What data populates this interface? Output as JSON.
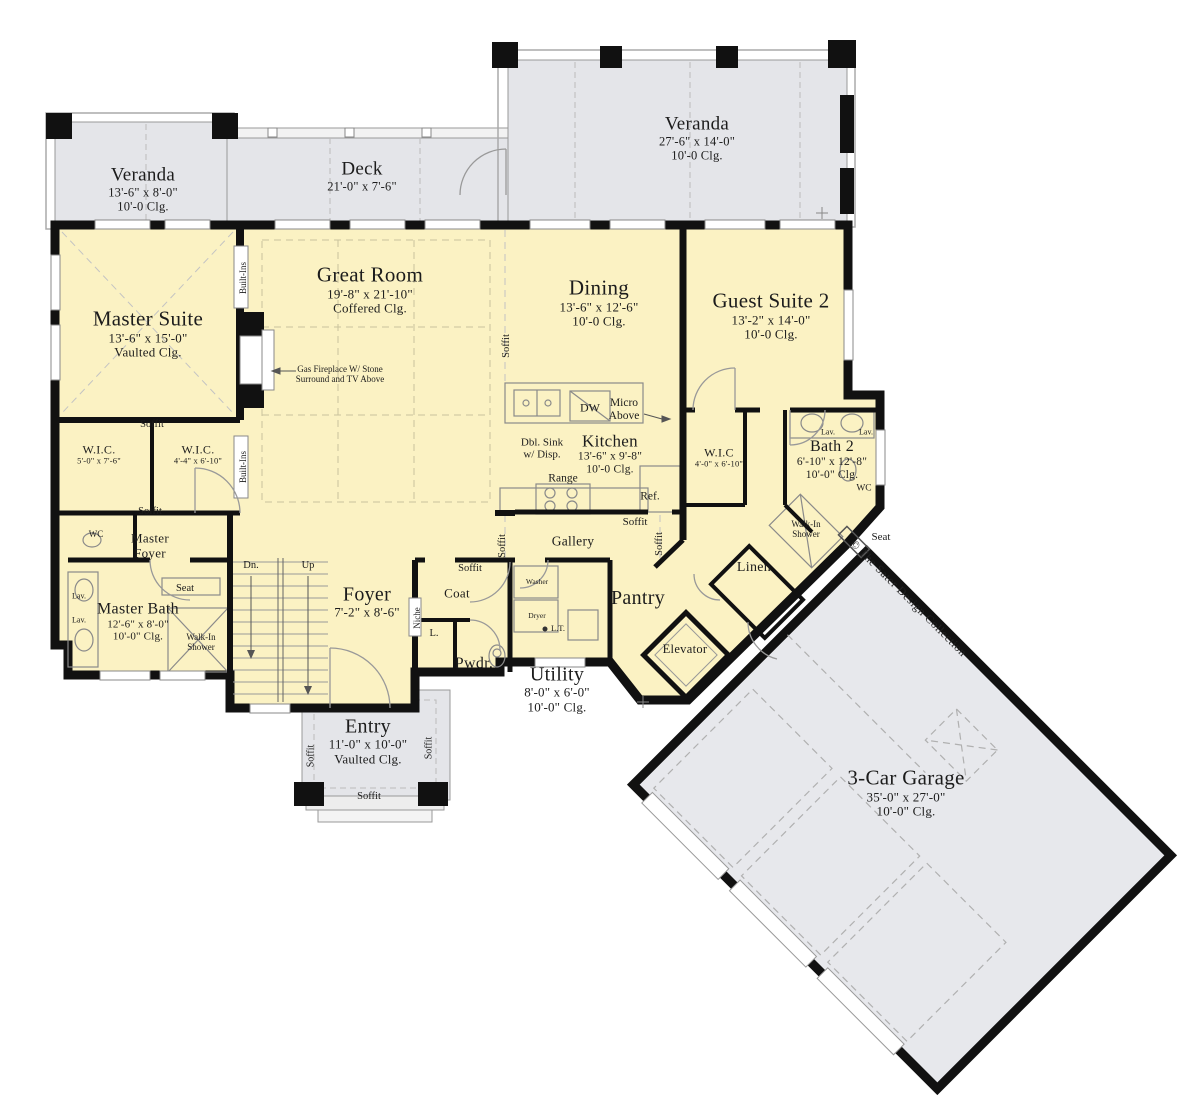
{
  "copyright": "© The Sater Design Collection",
  "colors": {
    "interior": "#fbf2c3",
    "outdoor": "#e4e5e9",
    "garage": "#e7e8ec",
    "wall": "#111111",
    "fixture_line": "#8a8a8a",
    "dashed_line": "#b9b9b9",
    "text": "#1c1c1c"
  },
  "rooms": [
    {
      "id": "veranda-left",
      "name": "Veranda",
      "dims": [
        "13'-6\" x 8'-0\"",
        "10'-0 Clg."
      ],
      "x": 143,
      "y": 189,
      "ns": 19,
      "ds": 12.5
    },
    {
      "id": "deck",
      "name": "Deck",
      "dims": [
        "21'-0\" x 7'-6\""
      ],
      "x": 362,
      "y": 176,
      "ns": 19,
      "ds": 12.5
    },
    {
      "id": "veranda-right",
      "name": "Veranda",
      "dims": [
        "27'-6\" x 14'-0\"",
        "10'-0 Clg."
      ],
      "x": 697,
      "y": 138,
      "ns": 19,
      "ds": 12.5
    },
    {
      "id": "great-room",
      "name": "Great Room",
      "dims": [
        "19'-8\" x 21'-10\"",
        "Coffered Clg."
      ],
      "x": 370,
      "y": 290,
      "ns": 21,
      "ds": 13
    },
    {
      "id": "dining",
      "name": "Dining",
      "dims": [
        "13'-6\" x 12'-6\"",
        "10'-0 Clg."
      ],
      "x": 599,
      "y": 303,
      "ns": 21,
      "ds": 13
    },
    {
      "id": "guest-suite-2",
      "name": "Guest Suite 2",
      "dims": [
        "13'-2\" x 14'-0\"",
        "10'-0 Clg."
      ],
      "x": 771,
      "y": 316,
      "ns": 21,
      "ds": 13
    },
    {
      "id": "master-suite",
      "name": "Master Suite",
      "dims": [
        "13'-6\" x 15'-0\"",
        "Vaulted Clg."
      ],
      "x": 148,
      "y": 334,
      "ns": 21,
      "ds": 13
    },
    {
      "id": "kitchen",
      "name": "Kitchen",
      "dims": [
        "13'-6\" x 9'-8\"",
        "10'-0 Clg."
      ],
      "x": 610,
      "y": 454,
      "ns": 17,
      "ds": 11.5
    },
    {
      "id": "wic-master-1",
      "name": "W.I.C.",
      "dims": [
        "5'-0\" x 7'-6\""
      ],
      "x": 99,
      "y": 455,
      "ns": 12,
      "ds": 8.5
    },
    {
      "id": "wic-master-2",
      "name": "W.I.C.",
      "dims": [
        "4'-4\" x 6'-10\""
      ],
      "x": 198,
      "y": 455,
      "ns": 12,
      "ds": 8.5
    },
    {
      "id": "wic-guest",
      "name": "W.I.C",
      "dims": [
        "4'-0\" x 6'-10\""
      ],
      "x": 719,
      "y": 458,
      "ns": 12,
      "ds": 8.5
    },
    {
      "id": "bath-2",
      "name": "Bath 2",
      "dims": [
        "6'-10\" x 12'-8\"",
        "10'-0\" Clg."
      ],
      "x": 832,
      "y": 460,
      "ns": 16,
      "ds": 11.5
    },
    {
      "id": "master-bath",
      "name": "Master Bath",
      "dims": [
        "12'-6\" x 8'-0\"",
        "10'-0\" Clg."
      ],
      "x": 138,
      "y": 622,
      "ns": 16,
      "ds": 11
    },
    {
      "id": "foyer",
      "name": "Foyer",
      "dims": [
        "7'-2\" x 8'-6\""
      ],
      "x": 367,
      "y": 602,
      "ns": 20,
      "ds": 13
    },
    {
      "id": "entry",
      "name": "Entry",
      "dims": [
        "11'-0\" x 10'-0\"",
        "Vaulted Clg."
      ],
      "x": 368,
      "y": 741,
      "ns": 20,
      "ds": 13
    },
    {
      "id": "utility",
      "name": "Utility",
      "dims": [
        "8'-0\" x 6'-0\"",
        "10'-0\" Clg."
      ],
      "x": 557,
      "y": 689,
      "ns": 20,
      "ds": 13
    },
    {
      "id": "pantry",
      "name": "Pantry",
      "dims": [],
      "x": 638,
      "y": 598,
      "ns": 20,
      "ds": 12
    },
    {
      "id": "gallery",
      "name": "Gallery",
      "dims": [],
      "x": 573,
      "y": 541,
      "ns": 13.5,
      "ds": 12
    },
    {
      "id": "coat",
      "name": "Coat",
      "dims": [],
      "x": 457,
      "y": 594,
      "ns": 13,
      "ds": 12
    },
    {
      "id": "pwdr",
      "name": "Pwdr.",
      "dims": [],
      "x": 474,
      "y": 664,
      "ns": 16,
      "ds": 12
    },
    {
      "id": "master-foyer",
      "name": "Master Foyer",
      "dims": [],
      "x": 150,
      "y": 546,
      "ns": 13,
      "ds": 12,
      "w": 64
    },
    {
      "id": "linen",
      "name": "Linen",
      "dims": [],
      "x": 754,
      "y": 568,
      "ns": 14,
      "ds": 12
    },
    {
      "id": "elevator",
      "name": "Elevator",
      "dims": [],
      "x": 685,
      "y": 649,
      "ns": 12.5,
      "ds": 12
    },
    {
      "id": "garage",
      "name": "3-Car Garage",
      "dims": [
        "35'-0\" x 27'-0\"",
        "10'-0\" Clg."
      ],
      "x": 906,
      "y": 793,
      "ns": 21,
      "ds": 13
    }
  ],
  "notes": [
    {
      "id": "fireplace-note",
      "text": "Gas Fireplace W/ Stone\nSurround and TV Above",
      "x": 340,
      "y": 374,
      "fs": 9
    },
    {
      "id": "dbl-sink",
      "text": "Dbl. Sink\nw/ Disp.",
      "x": 542,
      "y": 449,
      "fs": 11
    },
    {
      "id": "dw",
      "text": "DW",
      "x": 590,
      "y": 408,
      "fs": 12
    },
    {
      "id": "micro-above",
      "text": "Micro\nAbove",
      "x": 624,
      "y": 410,
      "fs": 11.5
    },
    {
      "id": "range",
      "text": "Range",
      "x": 563,
      "y": 479,
      "fs": 11.5
    },
    {
      "id": "ref",
      "text": "Ref.",
      "x": 650,
      "y": 497,
      "fs": 11.5
    },
    {
      "id": "washer",
      "text": "Washer",
      "x": 537,
      "y": 582,
      "fs": 7.5
    },
    {
      "id": "dryer",
      "text": "Dryer",
      "x": 537,
      "y": 616,
      "fs": 7.5
    },
    {
      "id": "laundry-tub",
      "text": "L.T.",
      "x": 558,
      "y": 629,
      "fs": 8.5
    },
    {
      "id": "linen-closet-l",
      "text": "L.",
      "x": 434,
      "y": 634,
      "fs": 10.5
    },
    {
      "id": "niche",
      "text": "Niche",
      "x": 417,
      "y": 618,
      "fs": 9,
      "v": true
    },
    {
      "id": "stairs-down",
      "text": "Dn.",
      "x": 251,
      "y": 566,
      "fs": 10.5
    },
    {
      "id": "stairs-up",
      "text": "Up",
      "x": 308,
      "y": 566,
      "fs": 10.5
    },
    {
      "id": "wc-master",
      "text": "WC",
      "x": 96,
      "y": 534,
      "fs": 9
    },
    {
      "id": "wc-bath2",
      "text": "WC",
      "x": 864,
      "y": 489,
      "fs": 9.5
    },
    {
      "id": "walkin-shower-master",
      "text": "Walk-In\nShower",
      "x": 201,
      "y": 642,
      "fs": 9
    },
    {
      "id": "walkin-shower-bath2",
      "text": "Walk-In\nShower",
      "x": 806,
      "y": 529,
      "fs": 9
    },
    {
      "id": "seat-master",
      "text": "Seat",
      "x": 185,
      "y": 589,
      "fs": 10.5
    },
    {
      "id": "seat-bath2",
      "text": "Seat",
      "x": 881,
      "y": 537,
      "fs": 11
    },
    {
      "id": "lav-master-1",
      "text": "Lav.",
      "x": 79,
      "y": 597,
      "fs": 8
    },
    {
      "id": "lav-master-2",
      "text": "Lav.",
      "x": 79,
      "y": 621,
      "fs": 8
    },
    {
      "id": "lav-bath2-1",
      "text": "Lav.",
      "x": 828,
      "y": 433,
      "fs": 8
    },
    {
      "id": "lav-bath2-2",
      "text": "Lav.",
      "x": 866,
      "y": 433,
      "fs": 8
    },
    {
      "id": "built-ins-top",
      "text": "Built-Ins",
      "x": 243,
      "y": 278,
      "fs": 9,
      "v": true
    },
    {
      "id": "built-ins-bottom",
      "text": "Built-Ins",
      "x": 243,
      "y": 467,
      "fs": 9,
      "v": true
    },
    {
      "id": "soffit-wic-top",
      "text": "Soffit",
      "x": 152,
      "y": 425,
      "fs": 10.5
    },
    {
      "id": "soffit-wic-bottom",
      "text": "Soffit",
      "x": 150,
      "y": 512,
      "fs": 10.5
    },
    {
      "id": "soffit-dining-left",
      "text": "Soffit",
      "x": 507,
      "y": 346,
      "fs": 10.5,
      "v": true
    },
    {
      "id": "soffit-gallery-left",
      "text": "Soffit",
      "x": 503,
      "y": 546,
      "fs": 10.5,
      "v": true
    },
    {
      "id": "soffit-gallery-right",
      "text": "Soffit",
      "x": 660,
      "y": 544,
      "fs": 10.5,
      "v": true
    },
    {
      "id": "soffit-kitchen",
      "text": "Soffit",
      "x": 635,
      "y": 522,
      "fs": 11
    },
    {
      "id": "soffit-coat",
      "text": "Soffit",
      "x": 470,
      "y": 569,
      "fs": 10.5
    },
    {
      "id": "soffit-entry-left",
      "text": "Soffit",
      "x": 311,
      "y": 756,
      "fs": 10,
      "v": true
    },
    {
      "id": "soffit-entry-right",
      "text": "Soffit",
      "x": 429,
      "y": 748,
      "fs": 10,
      "v": true
    },
    {
      "id": "soffit-entry-bottom",
      "text": "Soffit",
      "x": 369,
      "y": 797,
      "fs": 10.5
    }
  ]
}
